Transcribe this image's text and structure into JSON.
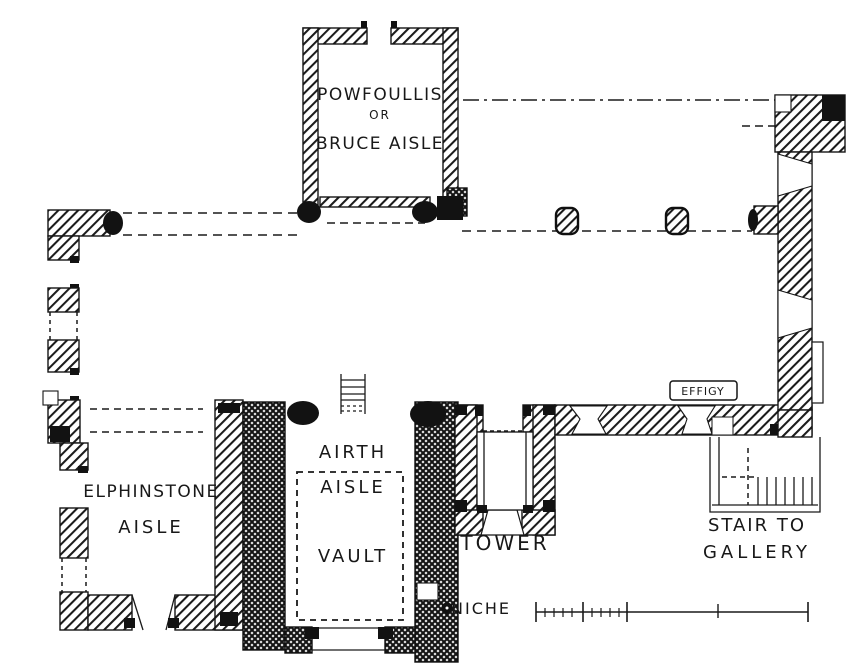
{
  "plan": {
    "colors": {
      "ink": "#181818",
      "paper": "#ffffff"
    },
    "rooms": {
      "powfoullis": {
        "lines": [
          "POWFOULLIS",
          "OR",
          "BRUCE AISLE"
        ]
      },
      "elphinstone": {
        "lines": [
          "ELPHINSTONE",
          "AISLE"
        ]
      },
      "airth": {
        "lines": [
          "AIRTH",
          "AISLE"
        ]
      },
      "vault": {
        "label": "VAULT"
      },
      "tower": {
        "label": "TOWER"
      },
      "stair": {
        "lines": [
          "STAIR TO",
          "GALLERY"
        ]
      }
    },
    "annotations": {
      "effigy": "EFFIGY",
      "niche": "NICHE"
    }
  }
}
